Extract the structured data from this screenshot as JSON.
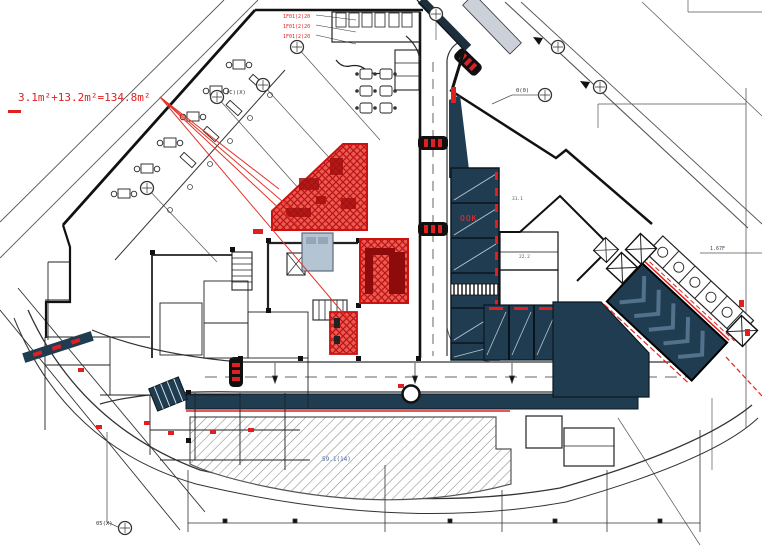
{
  "drawing": {
    "highlight_annotation": "3.1m²+13.2m²=134.8m²",
    "red_note_1": "1F01(2)20",
    "red_note_2": "1F01(2)20",
    "red_note_3": "1F01(2)20",
    "escalator_text": "OOK",
    "plaza_text": "59.1(14)",
    "dim_text_1": "31.1",
    "dim_text_2": "22.2",
    "dim_text_3": "33.3",
    "level_text": "1.67F",
    "grid_label_top_left": "(C)(X)",
    "grid_label_top_right": "0(0)",
    "grid_label_bottom_left": "05(X)"
  },
  "colors": {
    "highlight_red": "#e23228",
    "accent_red": "#e02020",
    "navy": "#203c50",
    "gray_blue": "#b5c4d3",
    "hatch_gray": "#8a8a8a"
  }
}
